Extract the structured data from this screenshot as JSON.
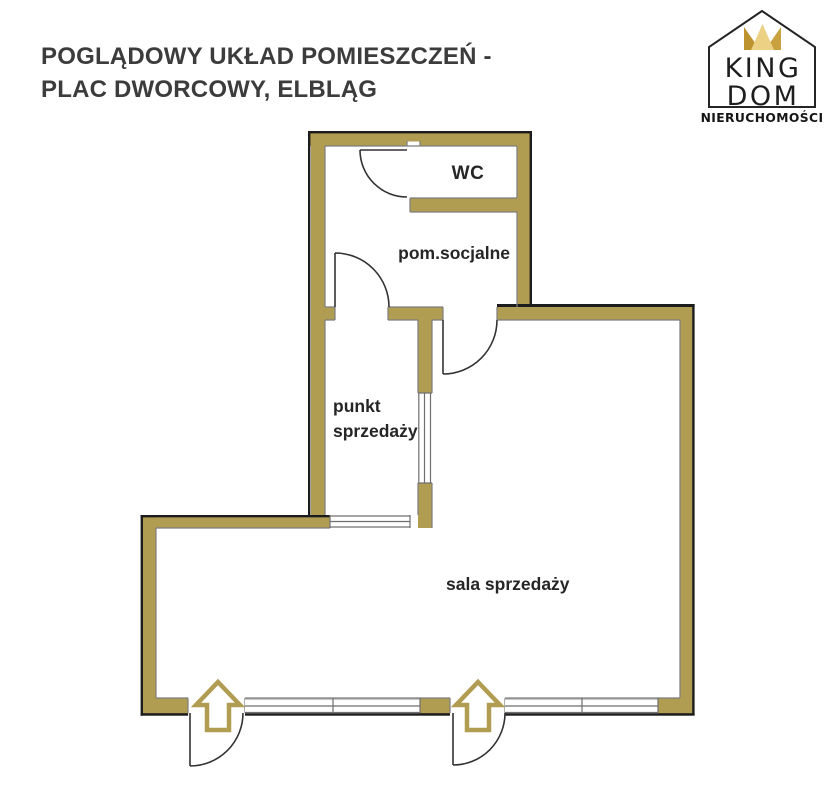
{
  "header": {
    "title_line1": "POGLĄDOWY UKŁAD POMIESZCZEŃ -",
    "title_line2": "PLAC DWORCOWY, ELBLĄG"
  },
  "logo": {
    "brand_line1": "KING",
    "brand_line2": "DOM",
    "subtitle": "NIERUCHOMOŚCI",
    "crown_gold_dark": "#bd9330",
    "crown_gold_light": "#ecd084"
  },
  "floorplan": {
    "wall_color": "#b19d52",
    "outline_color": "#1c1c1c",
    "entrance_arrow_color": "#b19d52",
    "rooms": [
      {
        "id": "wc",
        "label": "WC"
      },
      {
        "id": "pom-socjalne",
        "label": "pom.socjalne"
      },
      {
        "id": "punkt-sprzedazy",
        "label": "punkt\nsprzedaży"
      },
      {
        "id": "sala-sprzedazy",
        "label": "sala sprzedaży"
      }
    ]
  }
}
